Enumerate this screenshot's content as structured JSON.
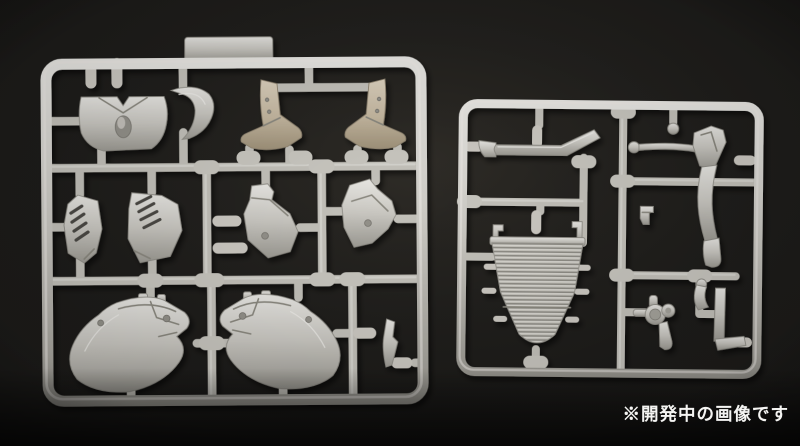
{
  "scene": {
    "description": "Photograph of two light-gray injection-molded plastic model kit runner sprues with motorcycle parts (cowl, fender, vented side panels, lower fairing halves, seat rail, radiator, frame tubes and pipes) on a dark background",
    "caption": "※開発中の画像です",
    "colors": {
      "background": "#1d1c1a",
      "background_deep": "#0b0a09",
      "plastic": "#c7c5bf",
      "plastic_highlight": "#eceae6",
      "plastic_shadow": "#8f8d86",
      "plastic_tan": "#c9bda7",
      "caption_text": "#f4f4f2"
    },
    "sprues": [
      {
        "name": "left-sprue",
        "description": "large square runner: upper cowl, front fender half, stay pair, vented side panels, angular brackets, two lower fairing halves, small blade part"
      },
      {
        "name": "right-sprue",
        "description": "smaller runner: seat-rail bar, radiator core with ribs, frame down-tube, brake drum, pipe parts"
      }
    ]
  }
}
